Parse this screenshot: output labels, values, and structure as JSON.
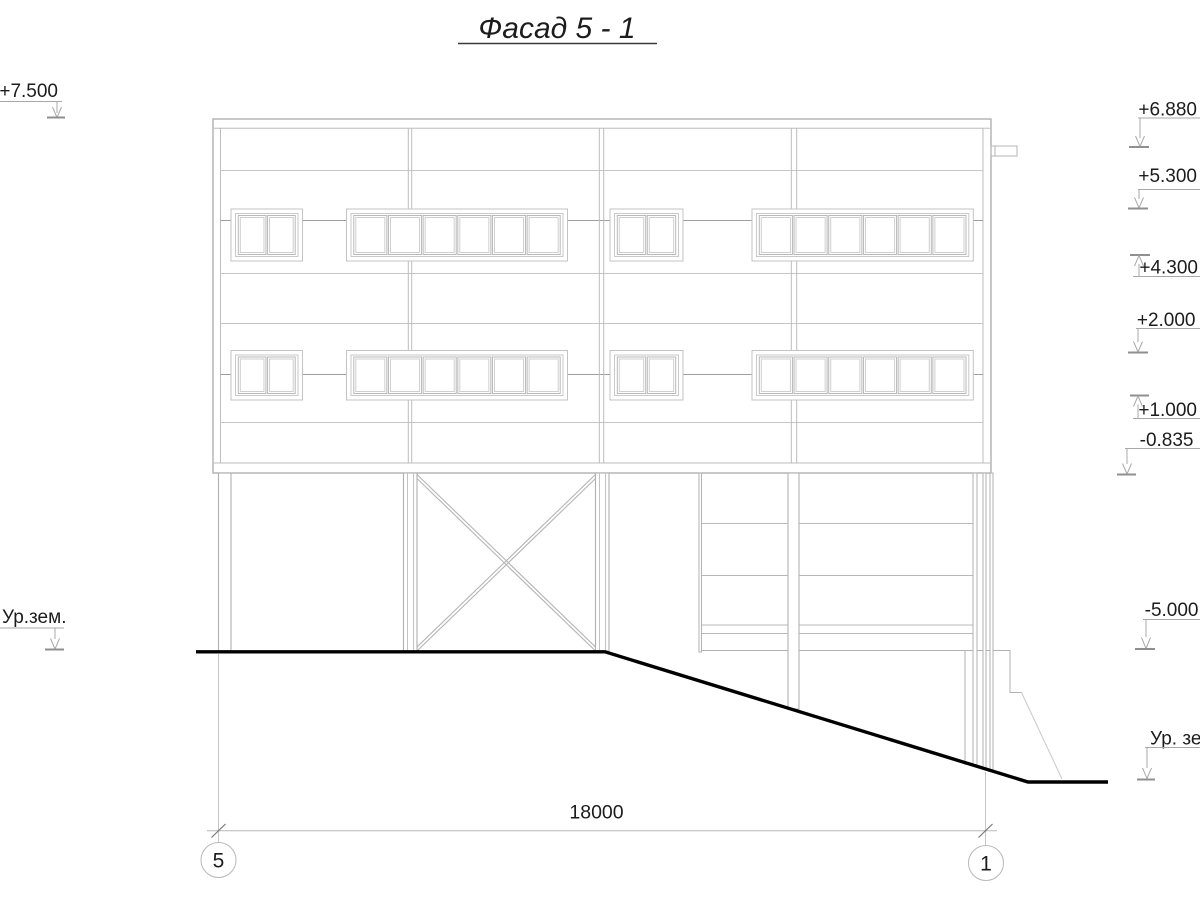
{
  "drawing": {
    "title": "Фасад 5 - 1",
    "elevation_marks_left": [
      {
        "label": "+7.500"
      },
      {
        "label": "Ур.зем."
      }
    ],
    "elevation_marks_right": [
      {
        "label": "+6.880"
      },
      {
        "label": "+5.300"
      },
      {
        "label": "+4.300"
      },
      {
        "label": "+2.000"
      },
      {
        "label": "+1.000"
      },
      {
        "label": "-0.835"
      },
      {
        "label": "-5.000"
      },
      {
        "label": "Ур. зе"
      }
    ],
    "dimension_total": "18000",
    "axis_bubbles": [
      {
        "label": "5"
      },
      {
        "label": "1"
      }
    ],
    "colors": {
      "line_light": "#c6c6c6",
      "line_mid": "#9e9e9e",
      "outline": "#ababab",
      "ground": "#000000",
      "text": "#1c1c1c"
    }
  }
}
